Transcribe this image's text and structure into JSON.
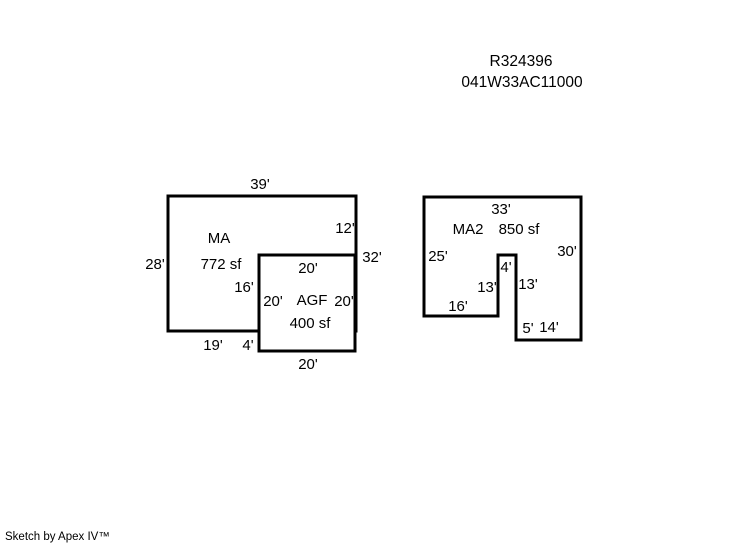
{
  "title": {
    "record_id": "R324396",
    "parcel_id": "041W33AC11000"
  },
  "buildings": {
    "ma": {
      "label": "MA",
      "area": "772 sf",
      "dim_top": "39'",
      "dim_left": "28'",
      "dim_right_upper": "12'",
      "dim_right_total": "32'",
      "dim_inner_left": "16'",
      "dim_bottom": "19'",
      "dim_bottom_step": "4'"
    },
    "agf": {
      "label": "AGF",
      "area": "400 sf",
      "dim_top": "20'",
      "dim_left": "20'",
      "dim_right": "20'",
      "dim_bottom": "20'"
    },
    "ma2": {
      "label": "MA2",
      "area": "850 sf",
      "dim_top": "33'",
      "dim_left": "25'",
      "dim_right": "30'",
      "dim_notch_width": "4'",
      "dim_notch_left": "13'",
      "dim_notch_right": "13'",
      "dim_bottom_left": "16'",
      "dim_step": "5'",
      "dim_bottom_right": "14'"
    }
  },
  "footer": {
    "credit": "Sketch by Apex IV™"
  }
}
